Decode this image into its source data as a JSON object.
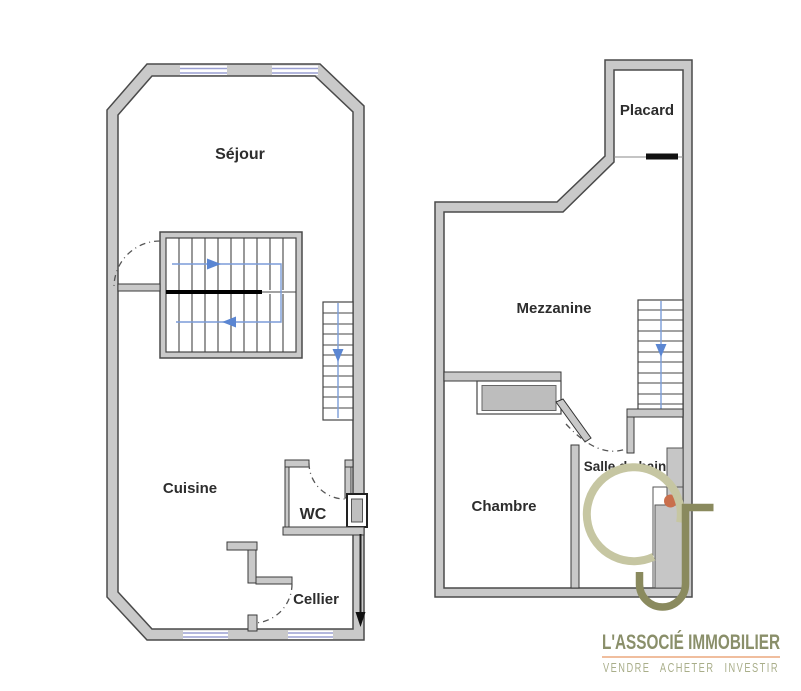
{
  "floor_plans": {
    "ground_floor": {
      "rooms": [
        {
          "label": "Séjour"
        },
        {
          "label": "Cuisine"
        },
        {
          "label": "WC"
        },
        {
          "label": "Cellier"
        }
      ],
      "features": [
        "central-staircase-up-down",
        "side-staircase-down",
        "windows-top-wall",
        "windows-bottom-wall",
        "entrance-arrow"
      ]
    },
    "upper_floor": {
      "rooms": [
        {
          "label": "Placard"
        },
        {
          "label": "Mezzanine"
        },
        {
          "label": "Salle de bain"
        },
        {
          "label": "Chambre"
        }
      ],
      "features": [
        "staircase-down",
        "wardrobe-alcove",
        "shower-column",
        "orange-marker-dot"
      ]
    }
  },
  "branding": {
    "agency_name": "L'ASSOCIÉ IMMOBILIER",
    "tagline": "VENDRE ACHETER INVESTIR",
    "monogram": "JC"
  },
  "colors": {
    "wall_fill": "#c9c9c9",
    "wall_outline": "#4a4a4a",
    "window": "#9a9fd2",
    "stair_path": "#5b86d2",
    "marker_dot": "#c96f4c",
    "logo_j": "#8a8a5e",
    "logo_c": "#c6c6a2",
    "brand_text": "#8a8f6a",
    "tagline_text": "#a9ae8a",
    "brand_divider": "#eba97f"
  }
}
